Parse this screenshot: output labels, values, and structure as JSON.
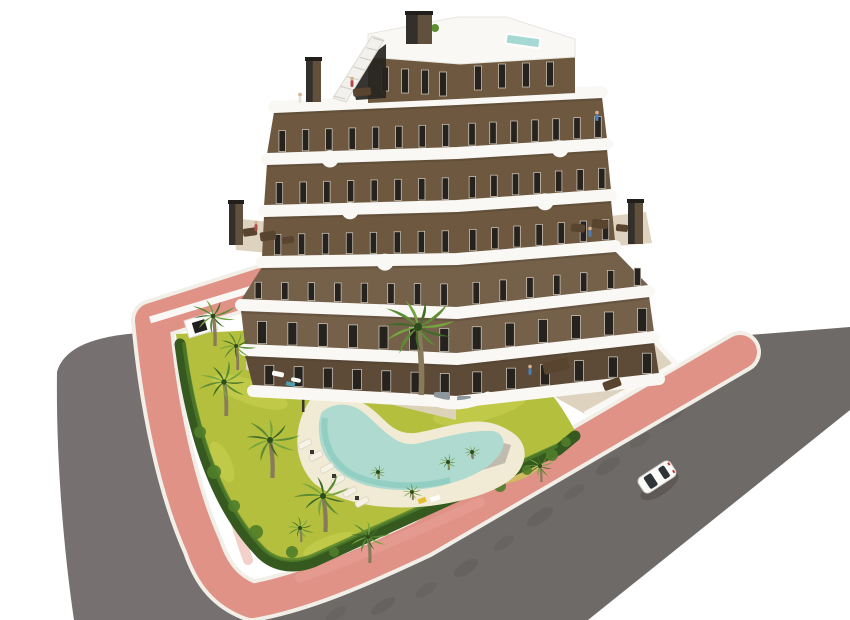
{
  "scene": {
    "type": "3d-architectural-render",
    "description": "Aerial 3D render of a modern V-shaped apartment building with brown facade, white curved zigzag balconies, rooftop terrace with plunge pool, landscaped garden with free-form swimming pool, sun loungers and palm trees, surrounded by a pink pedestrian path and grey asphalt roads with one white car"
  },
  "colors": {
    "background": "#ffffff",
    "road_left": "#767170",
    "road_right": "#6e6a68",
    "road_edge_shadow": "#55504e",
    "sidewalk_pink": "#e09286",
    "sidewalk_pink_light": "#e8a296",
    "curb_white": "#f2efe8",
    "lawn": "#b4bf3e",
    "lawn_light": "#c8d04f",
    "lawn_dark": "#9fae36",
    "hedge": "#35591f",
    "hedge_light": "#4f7d2a",
    "palm_dark": "#3f6b26",
    "palm_mid": "#5c8c33",
    "palm_light": "#74a53f",
    "palm_trunk": "#8a7a5c",
    "pool_water": "#aedad0",
    "pool_water_deep": "#8ccabf",
    "pool_deck": "#f1ead4",
    "gravel": "#b7b2a8",
    "island_bed": "#e9e0c6",
    "facade_brown": "#6e5940",
    "facade_brown_dark": "#5e4b37",
    "balcony_white": "#f9f8f5",
    "slab_shadow": "#4a3c2e",
    "window_dark": "#26221e",
    "window_frame": "#d7d0c5",
    "terrace_floor": "#ddd3bf",
    "furniture_brown": "#59442f",
    "furniture_gray": "#8e979c",
    "rooftop_pool": "#a6d9d4",
    "chimney_dark": "#33302b",
    "chimney_face": "#60503c",
    "stair_glass": "#262420",
    "person_red": "#b54a4a",
    "person_blue": "#4a7fb5",
    "car_body": "#fbfbfa",
    "car_glass": "#2e3438",
    "shadow": "#46423f"
  },
  "building": {
    "floors": 6,
    "penthouse": true,
    "shape": "V-shaped chevron with stepped floors",
    "features": [
      "rooftop plunge pool",
      "exterior staircase",
      "curved white balcony bands",
      "brown render facade",
      "three chimneys",
      "furnished terraces"
    ]
  },
  "landscape": {
    "pool": {
      "shape": "free-form boomerang",
      "water": "#aedad0"
    },
    "lounger_count": 6,
    "palms": [
      {
        "x": 213,
        "y": 316,
        "r": 24,
        "t": 30
      },
      {
        "x": 236,
        "y": 346,
        "r": 20,
        "t": 24
      },
      {
        "x": 224,
        "y": 382,
        "r": 27,
        "t": 34
      },
      {
        "x": 270,
        "y": 440,
        "r": 30,
        "t": 38
      },
      {
        "x": 323,
        "y": 496,
        "r": 30,
        "t": 36
      },
      {
        "x": 368,
        "y": 537,
        "r": 22,
        "t": 26
      },
      {
        "x": 300,
        "y": 528,
        "r": 15,
        "t": 14
      },
      {
        "x": 540,
        "y": 466,
        "r": 16,
        "t": 16
      },
      {
        "x": 448,
        "y": 462,
        "r": 10,
        "t": 8
      },
      {
        "x": 472,
        "y": 452,
        "r": 9,
        "t": 7
      },
      {
        "x": 412,
        "y": 492,
        "r": 11,
        "t": 8
      },
      {
        "x": 378,
        "y": 472,
        "r": 9,
        "t": 7
      },
      {
        "x": 418,
        "y": 327,
        "r": 40,
        "t": 68
      }
    ]
  },
  "vehicles": {
    "car": {
      "color": "white",
      "heading": "south-west along the road"
    }
  }
}
